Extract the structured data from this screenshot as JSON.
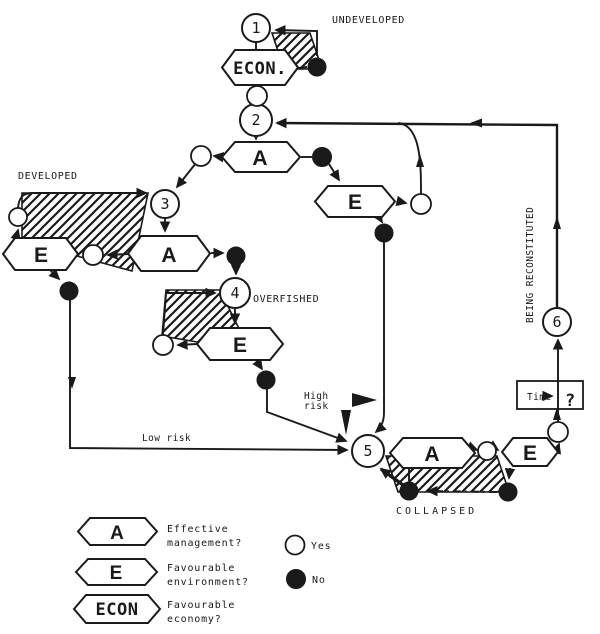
{
  "colors": {
    "ink": "#1a1a1a",
    "paper": "#ffffff"
  },
  "nodes": {
    "n1": "1",
    "n2": "2",
    "n3": "3",
    "n4": "4",
    "n5": "5",
    "n6": "6"
  },
  "states": {
    "undeveloped": "UNDEVELOPED",
    "developed": "DEVELOPED",
    "overfished": "OVERFISHED",
    "collapsed": "COLLAPSED",
    "being_reconstituted": "BEING RECONSTITUTED"
  },
  "decisions": {
    "econ": "ECON.",
    "management": "A",
    "environment": "E"
  },
  "annotations": {
    "high_risk_line1": "High",
    "high_risk_line2": "risk",
    "low_risk": "Low risk",
    "time_label": "Time",
    "time_question": "?"
  },
  "legend": {
    "items": [
      {
        "symbol": "A",
        "line1": "Effective",
        "line2": "management?"
      },
      {
        "symbol": "E",
        "line1": "Favourable",
        "line2": "environment?"
      },
      {
        "symbol": "ECON",
        "line1": "Favourable",
        "line2": "economy?"
      }
    ],
    "yes_label": "Yes",
    "no_label": "No"
  }
}
